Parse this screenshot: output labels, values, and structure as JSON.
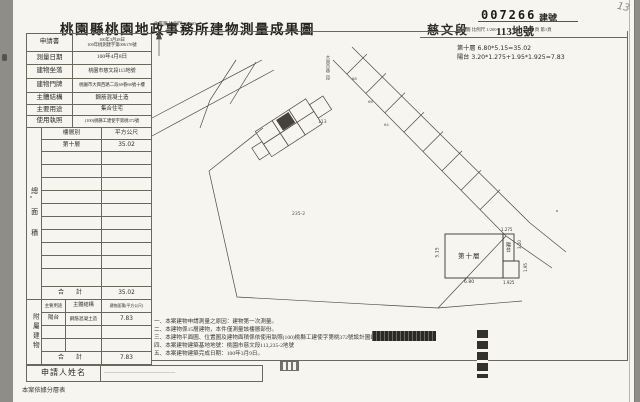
{
  "header": {
    "office_title": "桃園縣桃園地政事務所建物測量成果圖",
    "section_label": "慈文段",
    "lot_label": "113地號",
    "building_no_stamp": "007266",
    "building_no_suffix": "建號",
    "plan_scale": "平面圖 比例尺 1/200",
    "page_info": "共1頁 第1頁",
    "location_scale": "位置圖 比例尺 1/1000",
    "corner_mark": "13"
  },
  "info_table": {
    "rows": [
      {
        "label": "申請書",
        "value": "100年3月28日",
        "value2": "100年桃測建字第006170號"
      },
      {
        "label": "測量日期",
        "value": "100年4月8日"
      },
      {
        "label": "建物坐落",
        "value": "桃園市慈文段113地號"
      },
      {
        "label": "建物門牌",
        "value": "桃園市大興西路二段69巷68號十樓"
      },
      {
        "label": "主體結構",
        "value": "鋼筋混凝土造"
      },
      {
        "label": "主要用途",
        "value": "集合住宅"
      },
      {
        "label": "使用執照",
        "value": "(100)桃縣工建使字第桃372號"
      }
    ]
  },
  "area_table": {
    "side_label": "總面積",
    "col_floor": "樓層別",
    "col_sqm": "平方公尺",
    "row_floor": "第十層",
    "row_sqm": "35.02",
    "total_label": "合　計",
    "total_value": "35.02"
  },
  "annex_table": {
    "side_label": "附屬建物",
    "col_use": "主要用途",
    "col_structure": "主體結構",
    "col_area": "建物面積(平方公尺)",
    "row_use": "陽台",
    "row_structure": "鋼筋混凝土造",
    "row_area": "7.83",
    "total_label": "合　計",
    "total_value": "7.83"
  },
  "applicant": {
    "label": "申請人姓名",
    "value": "────────────────────────────"
  },
  "footer_note": "本案依據分層表",
  "notes": {
    "lines": [
      "一、本案建物申請測量之原因：建物第一次測量。",
      "二、本建物係15層建物，本件僅測量該樓層部份。",
      "三、本建物平面圖、位置圖及建物面積係依使用執照(100)桃縣工建使字第桃372號設計圖竣工平面圖轉繪計算。",
      "四、本案建物建築基地地號：桃園市慈文段113,235-2地號",
      "五、本案建物建築完成日期：100年3月9日。"
    ]
  },
  "location_map": {
    "road_label": "大興西路二段",
    "lot_113": "113",
    "lot_235": "235-2",
    "strip_a": "68",
    "strip_b": "66",
    "strip_c": "64"
  },
  "plan": {
    "floor_label": "第十層",
    "dim_width": "6.80",
    "dim_height": "5.15",
    "balcony_label": "陽台",
    "dim_balcony_top": "1.275",
    "dim_balcony_right_upper": "3.20",
    "dim_balcony_right_lower": "1.95",
    "dim_balcony_bottom": "1.925",
    "formula_floor": "第十層 6.80*5.15=35.02",
    "formula_balcony": "陽台 3.20*1.275+1.95*1.925=7.83"
  }
}
